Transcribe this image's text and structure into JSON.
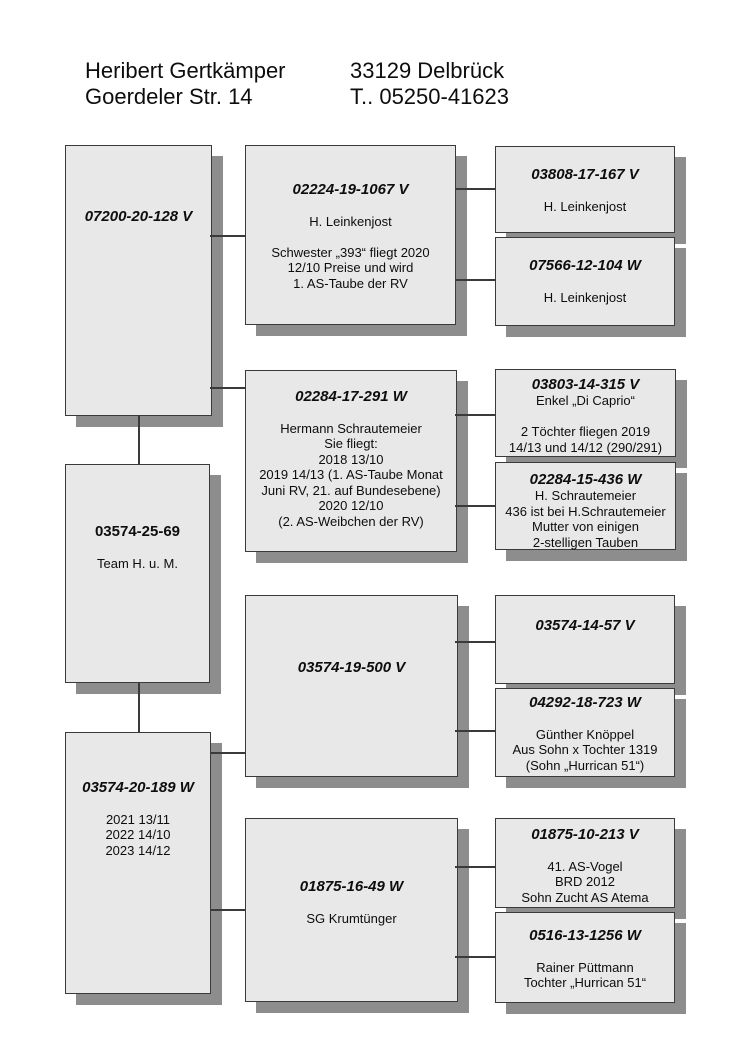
{
  "title_block": {
    "name": "Heribert Gertkämper",
    "street": "Goerdeler Str. 14",
    "city": "33129 Delbrück",
    "phone": "T.. 05250-41623"
  },
  "colors": {
    "background": "#ffffff",
    "box_fill": "#e8e8e8",
    "box_border": "#3a3a3a",
    "shadow": "#8d8d8d",
    "connector": "#3a3a3a",
    "text": "#0d0d0d"
  },
  "boxes": {
    "l1": {
      "ring": "07200-20-128 V",
      "lines": []
    },
    "l2": {
      "ring": "03574-25-69",
      "lines": [
        "",
        "Team H. u. M."
      ]
    },
    "l3": {
      "ring": "03574-20-189 W",
      "lines": [
        "",
        "2021 13/11",
        "2022 14/10",
        "2023 14/12"
      ]
    },
    "m1": {
      "ring": "02224-19-1067 V",
      "lines": [
        "",
        "H. Leinkenjost",
        "",
        "Schwester „393“ fliegt 2020",
        "12/10 Preise und wird",
        "1. AS-Taube der RV"
      ]
    },
    "m2": {
      "ring": "02284-17-291 W",
      "lines": [
        "",
        "Hermann Schrautemeier",
        "Sie fliegt:",
        "2018 13/10",
        "2019 14/13 (1. AS-Taube Monat",
        "Juni RV, 21. auf Bundesebene)",
        "2020 12/10",
        "(2. AS-Weibchen der RV)"
      ]
    },
    "m3": {
      "ring": "03574-19-500 V",
      "lines": []
    },
    "m4": {
      "ring": "01875-16-49 W",
      "lines": [
        "",
        "SG Krumtünger"
      ]
    },
    "r1": {
      "ring": "03808-17-167 V",
      "lines": [
        "",
        "H. Leinkenjost"
      ]
    },
    "r2": {
      "ring": "07566-12-104 W",
      "lines": [
        "",
        "H. Leinkenjost"
      ]
    },
    "r3": {
      "ring": "03803-14-315 V",
      "lines": [
        "Enkel „Di Caprio“",
        "",
        "2 Töchter fliegen 2019",
        "14/13 und 14/12 (290/291)"
      ]
    },
    "r4": {
      "ring": "02284-15-436 W",
      "lines": [
        "H. Schrautemeier",
        "436 ist bei H.Schrautemeier",
        "Mutter von einigen",
        "2-stelligen Tauben"
      ]
    },
    "r5": {
      "ring": "03574-14-57 V",
      "lines": []
    },
    "r6": {
      "ring": "04292-18-723 W",
      "lines": [
        "",
        "Günther Knöppel",
        "Aus Sohn x Tochter 1319",
        "(Sohn „Hurrican 51“)"
      ]
    },
    "r7": {
      "ring": "01875-10-213 V",
      "lines": [
        "",
        "41. AS-Vogel",
        "BRD 2012",
        "Sohn Zucht AS Atema"
      ]
    },
    "r8": {
      "ring": "0516-13-1256 W",
      "lines": [
        "",
        "Rainer Püttmann",
        "Tochter „Hurrican 51“"
      ]
    }
  }
}
